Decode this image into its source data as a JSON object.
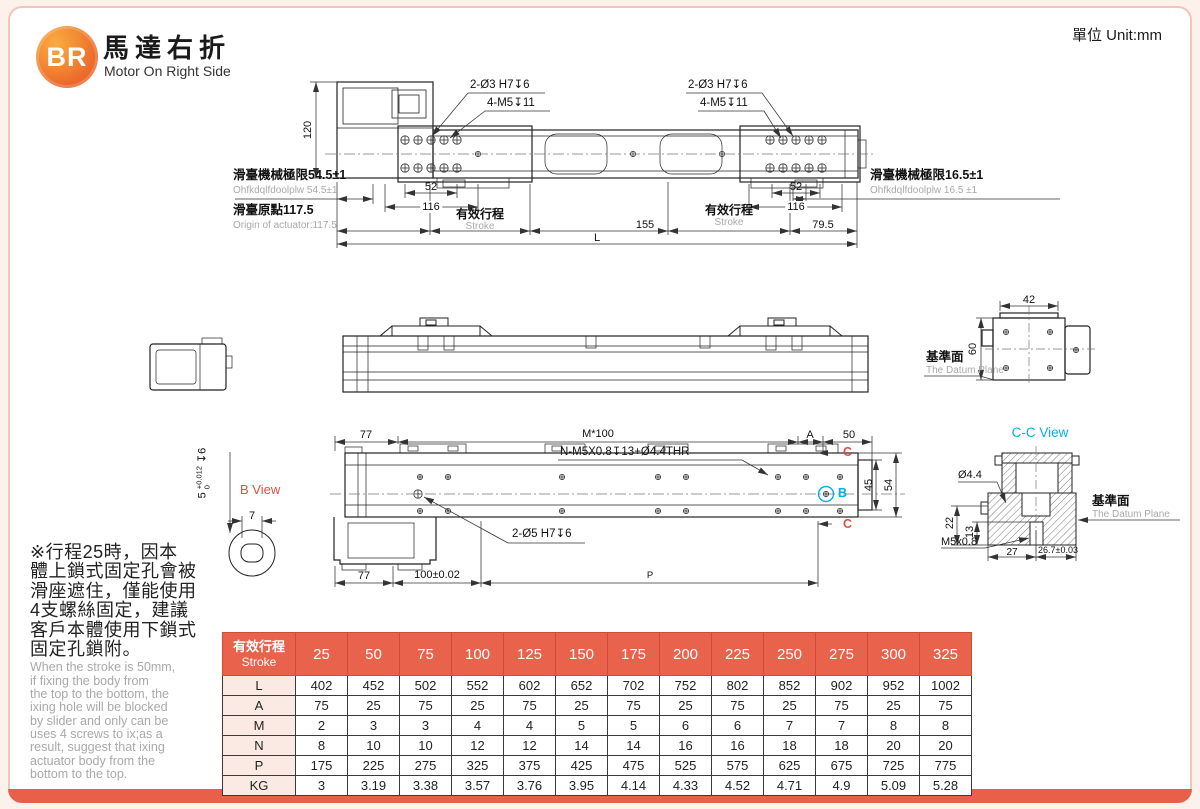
{
  "frame": {
    "unit": "單位 Unit:mm"
  },
  "header": {
    "logo": "BR",
    "title_zh": "馬達右折",
    "title_en": "Motor On Right Side"
  },
  "top_view": {
    "dim_120": "120",
    "holes_left_1": "2-Ø3 H7↧6",
    "holes_left_2": "4-M5↧11",
    "holes_right_1": "2-Ø3 H7↧6",
    "holes_right_2": "4-M5↧11",
    "limit_left_zh": "滑臺機械極限54.5±1",
    "limit_left_en": "Ohfkdqlfdoolplw 54.5±1",
    "origin_zh": "滑臺原點117.5",
    "origin_en": "Origin of actuator:117.5",
    "dim_52_left": "52",
    "dim_116_left": "116",
    "stroke_left_zh": "有效行程",
    "stroke_left_en": "Stroke",
    "dim_155": "155",
    "stroke_right_zh": "有效行程",
    "stroke_right_en": "Stroke",
    "dim_79_5": "79.5",
    "dim_52_right": "52",
    "dim_116_right": "116",
    "limit_right_zh": "滑臺機械極限16.5±1",
    "limit_right_en": "Ohfkdqlfdoolplw 16.5 ±1",
    "dim_L": "L"
  },
  "end_view": {
    "dim_42": "42",
    "dim_60": "60",
    "datum_zh": "基準面",
    "datum_en": "The Datum Plane"
  },
  "plan_view": {
    "dim_77_top": "77",
    "dim_m100": "M*100",
    "dim_A": "A",
    "dim_50": "50",
    "label_thread": "N-M5X0.8↧13+Ø4.4THR",
    "label_dowel": "2-Ø5 H7↧6",
    "section_c": "C",
    "marker_b": "B",
    "dim_45": "45",
    "dim_54": "54",
    "dim_77_bottom": "77",
    "dim_100": "100±0.02",
    "dim_P": "P"
  },
  "b_view": {
    "title": "B View",
    "dim_7": "7",
    "tol_base": "5",
    "tol_up": "+0.012",
    "tol_dn": "0",
    "tol_depth": "↧6"
  },
  "cc_view": {
    "title": "C-C View",
    "dim_d44": "Ø4.4",
    "dim_22": "22",
    "dim_13": "13",
    "dim_m5": "M5x0.8",
    "dim_27": "27",
    "dim_267": "26.7±0.03",
    "datum_zh": "基準面",
    "datum_en": "The Datum Plane"
  },
  "note": {
    "zh": "※行程25時，因本\n體上鎖式固定孔會被\n滑座遮住，僅能使用\n4支螺絲固定，建議\n客戶本體使用下鎖式\n固定孔鎖附。",
    "en": "When the stroke is 50mm,\nif fixing the body from\nthe top to the bottom, the\nixing hole will be blocked\nby slider and only can be\nuses 4 screws to ix;as a\nresult, suggest that ixing\nactuator body from the\nbottom to the top."
  },
  "table": {
    "header_zh": "有效行程",
    "header_en": "Stroke",
    "strokes": [
      "25",
      "50",
      "75",
      "100",
      "125",
      "150",
      "175",
      "200",
      "225",
      "250",
      "275",
      "300",
      "325"
    ],
    "rows": [
      {
        "label": "L",
        "values": [
          "402",
          "452",
          "502",
          "552",
          "602",
          "652",
          "702",
          "752",
          "802",
          "852",
          "902",
          "952",
          "1002"
        ]
      },
      {
        "label": "A",
        "values": [
          "75",
          "25",
          "75",
          "25",
          "75",
          "25",
          "75",
          "25",
          "75",
          "25",
          "75",
          "25",
          "75"
        ]
      },
      {
        "label": "M",
        "values": [
          "2",
          "3",
          "3",
          "4",
          "4",
          "5",
          "5",
          "6",
          "6",
          "7",
          "7",
          "8",
          "8"
        ]
      },
      {
        "label": "N",
        "values": [
          "8",
          "10",
          "10",
          "12",
          "12",
          "14",
          "14",
          "16",
          "16",
          "18",
          "18",
          "20",
          "20"
        ]
      },
      {
        "label": "P",
        "values": [
          "175",
          "225",
          "275",
          "325",
          "375",
          "425",
          "475",
          "525",
          "575",
          "625",
          "675",
          "725",
          "775"
        ]
      },
      {
        "label": "KG",
        "values": [
          "3",
          "3.19",
          "3.38",
          "3.57",
          "3.76",
          "3.95",
          "4.14",
          "4.33",
          "4.52",
          "4.71",
          "4.9",
          "5.09",
          "5.28"
        ]
      }
    ]
  },
  "colors": {
    "accent": "#e8604a",
    "cyan": "#00b0e8",
    "red_label": "#d9534a",
    "gray_text": "#a9a9a9"
  }
}
